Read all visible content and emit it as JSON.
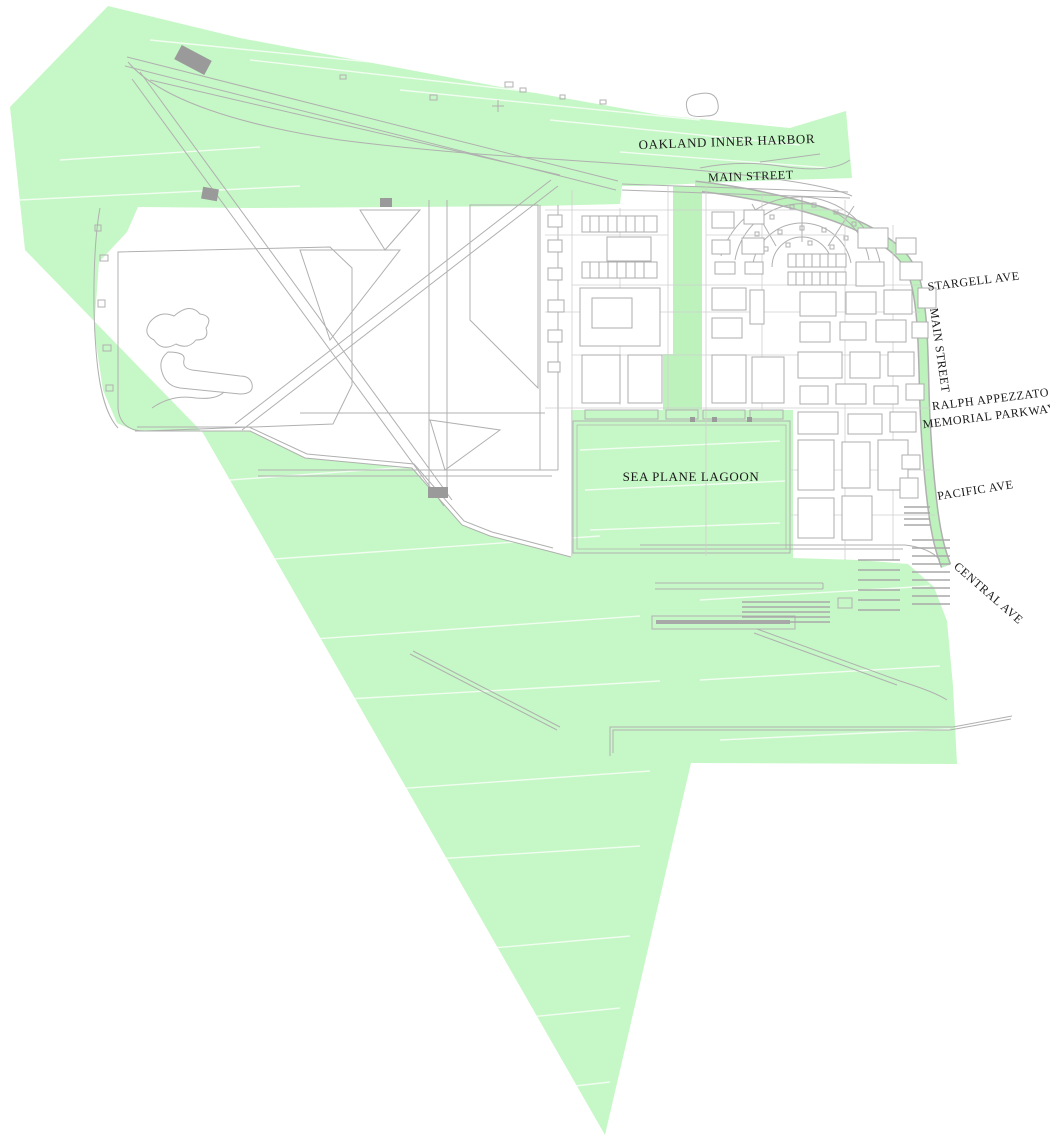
{
  "map": {
    "title_note": "site plan with green open-space/water overlay",
    "labels": {
      "oakland_inner_harbor": "OAKLAND INNER HARBOR",
      "main_street_top": "MAIN STREET",
      "stargell_ave": "STARGELL AVE",
      "main_street_east": "MAIN STREET",
      "ralph_appezzato_line1": "RALPH APPEZZATO",
      "ralph_appezzato_line2": "MEMORIAL PARKWAY",
      "pacific_ave": "PACIFIC AVE",
      "central_ave": "CENTRAL AVE",
      "sea_plane_lagoon": "SEA PLANE LAGOON"
    },
    "colors": {
      "overlay_green": "#c6f7c6",
      "corridor_green": "#bdf2bd",
      "linework_gray": "#b0b0b0",
      "grid_gray": "#cfcfcf",
      "pad_gray": "#9a9a9a",
      "label_text": "#1a1a1a",
      "background": "#ffffff",
      "water_hatch": "#ffffff"
    }
  }
}
